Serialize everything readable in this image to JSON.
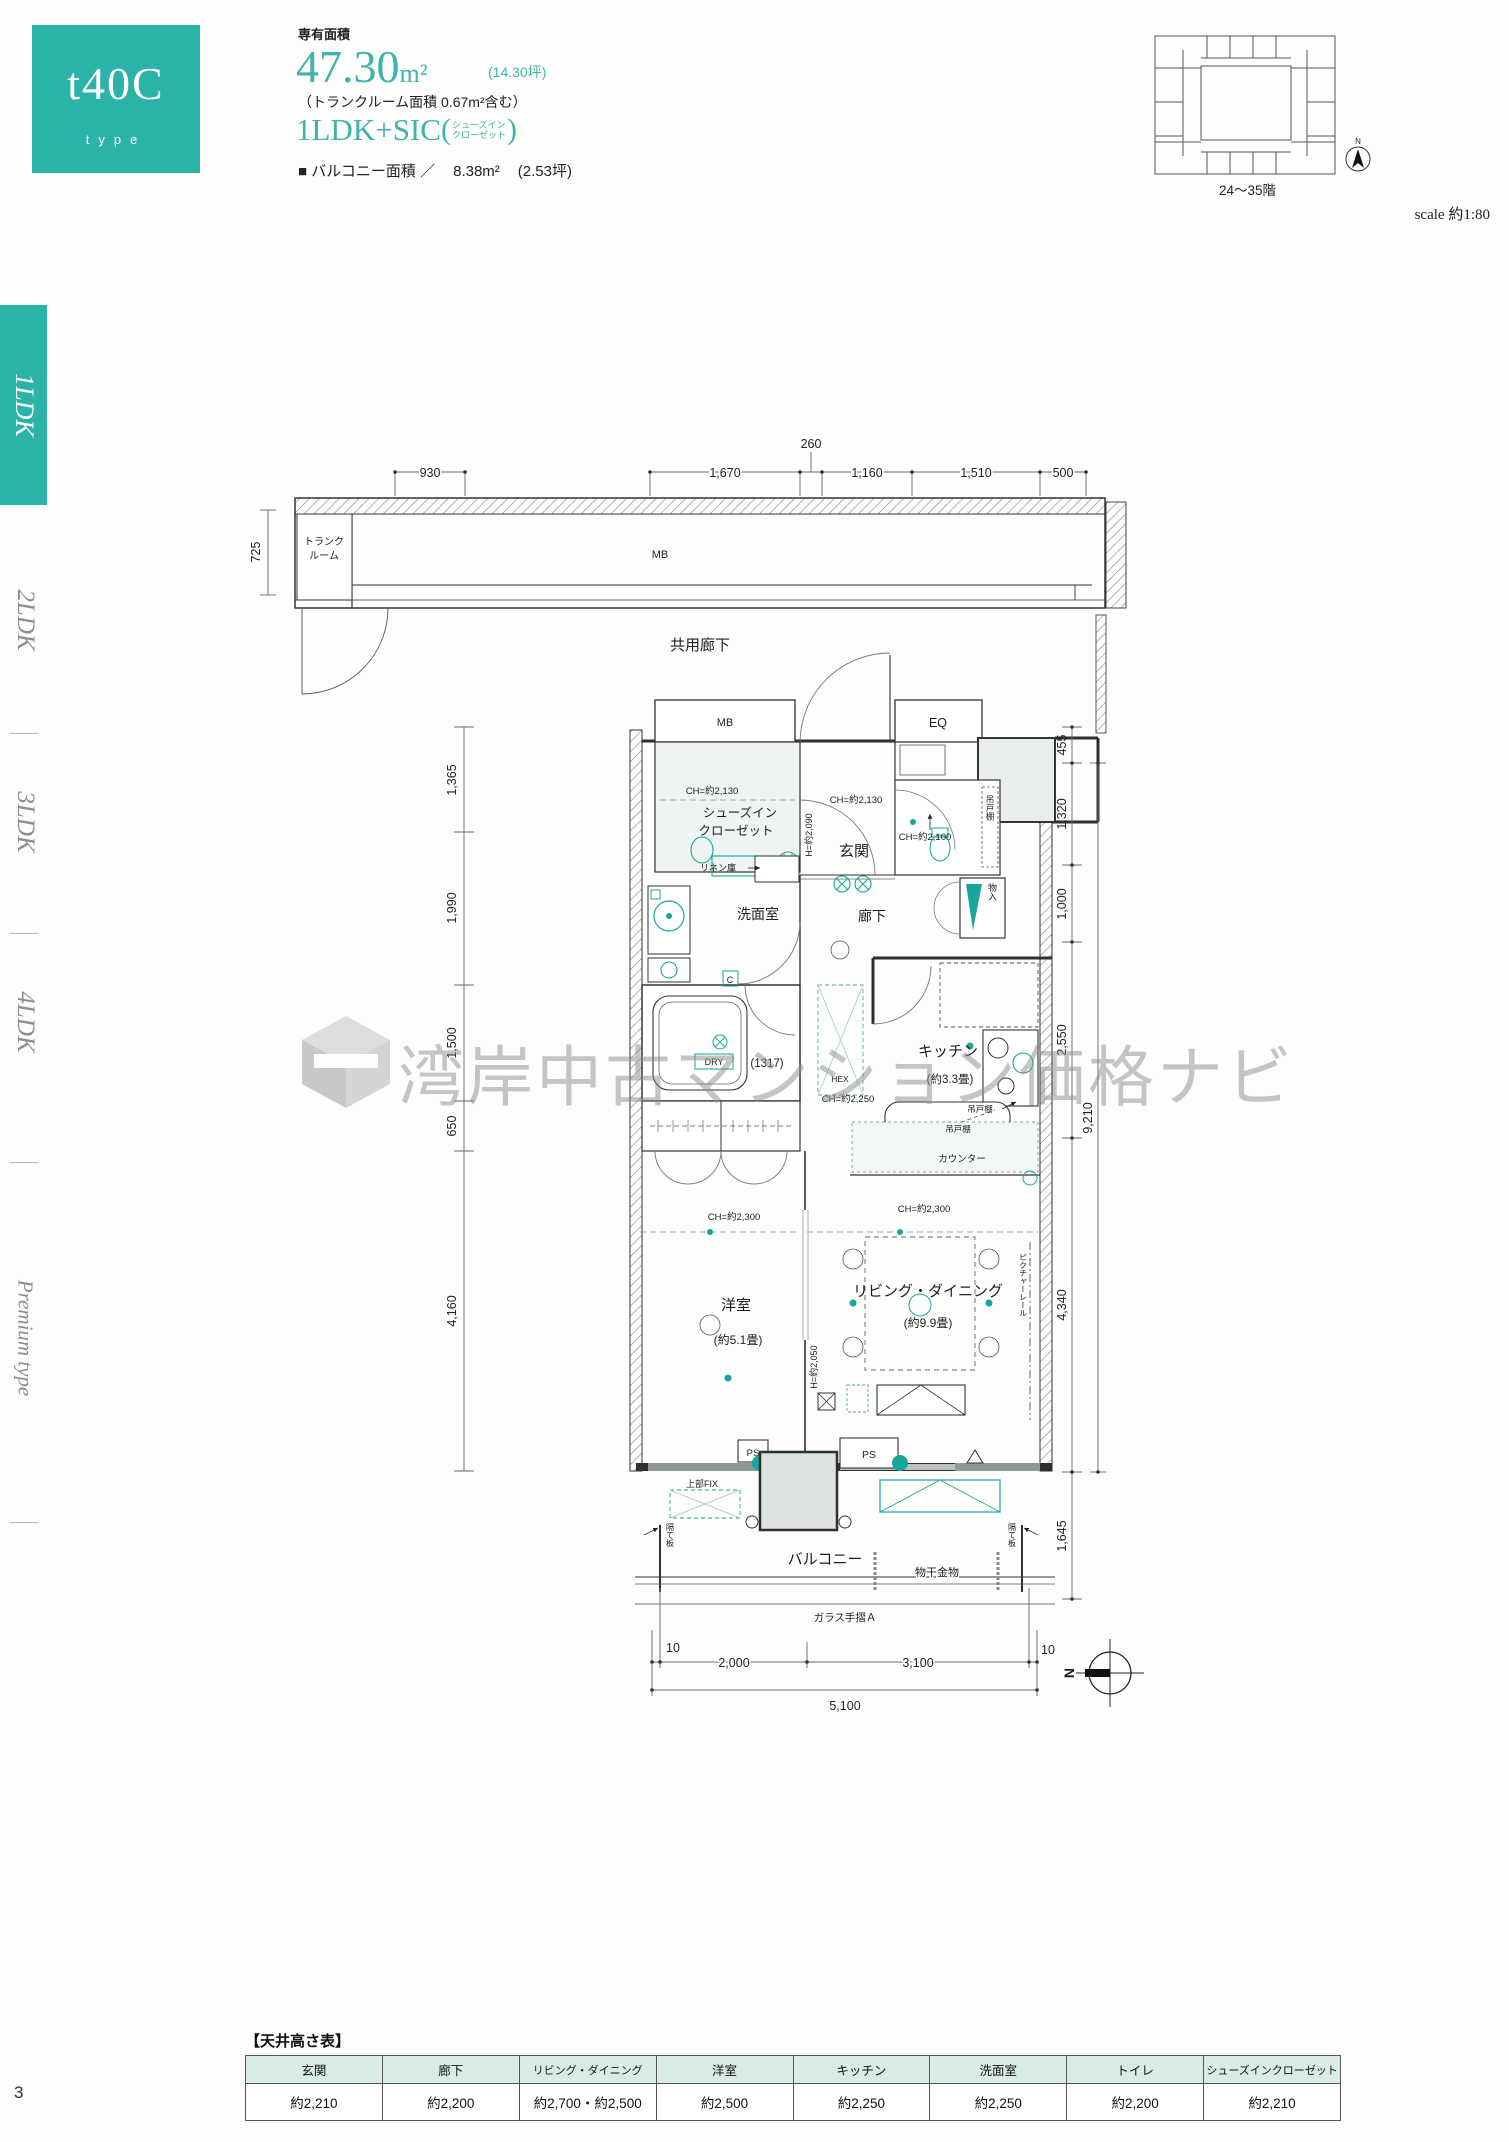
{
  "page": {
    "number": "3"
  },
  "header": {
    "type_code": "t40C",
    "type_word": "type",
    "area_label": "専有面積",
    "area_value": "47.30",
    "area_unit": "m²",
    "area_tsubo": "(14.30坪)",
    "trunk_note": "（トランクルーム面積 0.67m²含む）",
    "layout": "1LDK+SIC",
    "paren_open": "(",
    "layout_note1": "シューズイン",
    "layout_note2": "クローゼット",
    "paren_close": ")",
    "balcony_label": "■ バルコニー面積 ／",
    "balcony_value": "8.38m²",
    "balcony_tsubo": "(2.53坪)"
  },
  "keyplan": {
    "caption": "24〜35階",
    "scale": "scale 約1:80",
    "north": "N"
  },
  "sidebar": {
    "items": [
      {
        "label": "1LDK"
      },
      {
        "label": "2LDK"
      },
      {
        "label": "3LDK"
      },
      {
        "label": "4LDK"
      },
      {
        "label": "Premium type"
      }
    ]
  },
  "corridor": {
    "dims": [
      "930",
      "1,670",
      "260",
      "1,160",
      "1,510",
      "500"
    ],
    "dim_left": "725",
    "trunk1": "トランク",
    "trunk2": "ルーム",
    "mb": "MB",
    "label": "共用廊下"
  },
  "plan": {
    "dims_left": [
      "1,365",
      "1,990",
      "1,500",
      "650",
      "4,160"
    ],
    "dims_right": [
      "455",
      "1,320",
      "1,000",
      "2,550",
      "4,340",
      "1,645"
    ],
    "dim_right_total": "9,210",
    "dims_bottom": [
      "10",
      "2,000",
      "3,100",
      "10"
    ],
    "dim_bottom_total": "5,100",
    "labels": {
      "mb": "MB",
      "eq": "EQ",
      "ch_sic": "CH=約2,130",
      "sic1": "シューズイン",
      "sic2": "クローゼット",
      "h_entry": "H=約2,090",
      "ch_entry": "CH=約2,130",
      "entry": "玄関",
      "ch_toilet": "CH=約2,100",
      "hanging1": "吊戸棚",
      "storage": "物入",
      "linen": "リネン庫",
      "washroom": "洗面室",
      "hallway": "廊下",
      "dry": "DRY",
      "c_mark": "C",
      "bath_size": "(1317)",
      "hex": "HEX",
      "ch_hall": "CH=約2,250",
      "kitchen": "キッチン",
      "kitchen_size": "(約3.3畳)",
      "hanging2": "吊戸棚",
      "hanging3": "吊戸棚",
      "counter": "カウンター",
      "ch_west": "CH=約2,300",
      "west_room": "洋室",
      "west_size": "(約5.1畳)",
      "ch_ld": "CH=約2,300",
      "ld": "リビング・ダイニング",
      "ld_size": "(約9.9畳)",
      "h_ld": "H=約2,050",
      "picture_rail": "ピクチャーレール",
      "ps1": "PS",
      "ps2": "PS",
      "fix": "上部FIX",
      "balcony": "バルコニー",
      "drying": "物干金物",
      "divider1": "隔て板",
      "divider2": "隔て板",
      "glass": "ガラス手摺Ａ",
      "north": "N"
    }
  },
  "watermark": {
    "text": "湾岸中古マンション価格ナビ"
  },
  "ceiling_table": {
    "title": "【天井高さ表】",
    "columns": [
      {
        "room": "玄関",
        "height": "約2,210"
      },
      {
        "room": "廊下",
        "height": "約2,200"
      },
      {
        "room": "リビング・ダイニング",
        "height": "約2,700・約2,500"
      },
      {
        "room": "洋室",
        "height": "約2,500"
      },
      {
        "room": "キッチン",
        "height": "約2,250"
      },
      {
        "room": "洗面室",
        "height": "約2,250"
      },
      {
        "room": "トイレ",
        "height": "約2,200"
      },
      {
        "room": "シューズインクローゼット",
        "height": "約2,210"
      }
    ]
  }
}
